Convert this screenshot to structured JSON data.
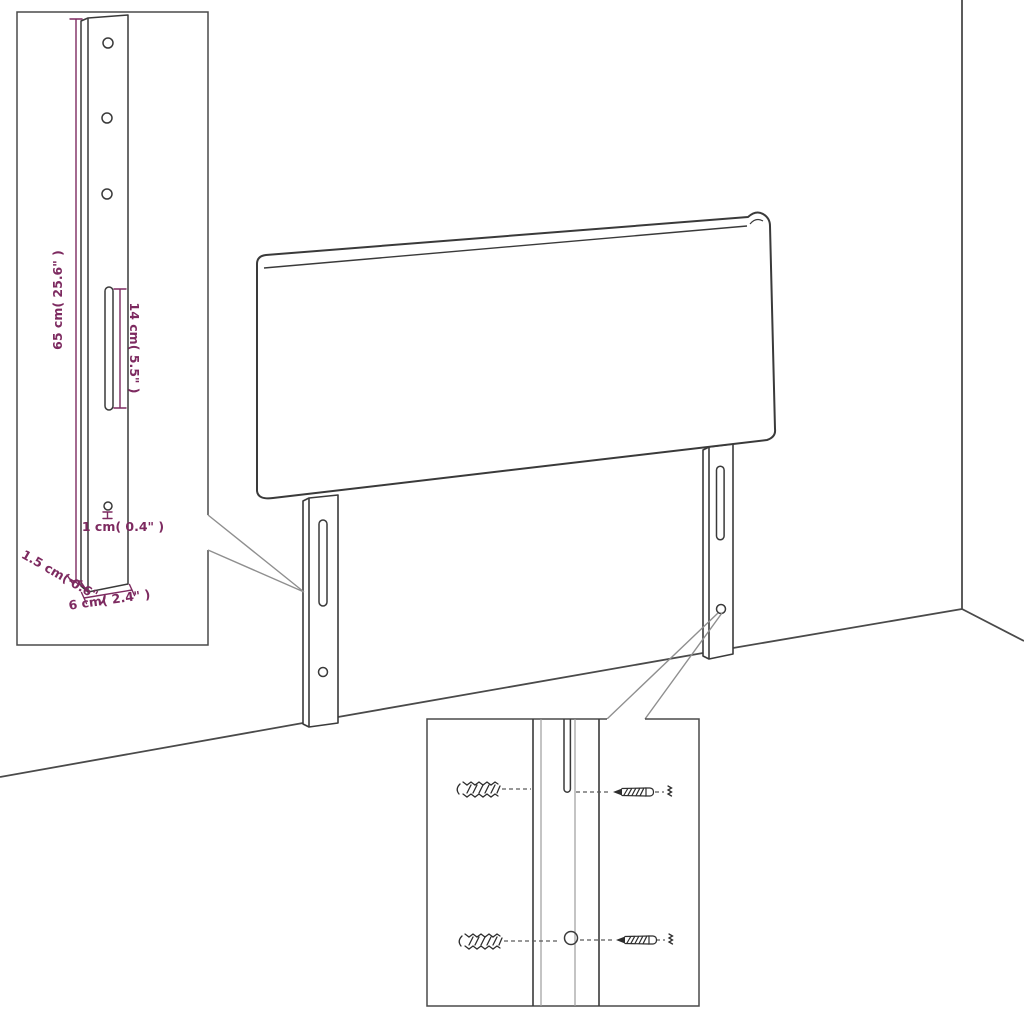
{
  "page": {
    "title": "headboard-assembly-diagram"
  },
  "insets": {
    "bracket_detail": {
      "dims": {
        "height": "65 cm( 25.6\" )",
        "slot_length": "14 cm( 5.5\" )",
        "hole_diameter": "1 cm( 0.4\" )",
        "thickness": "1.5 cm( 0.6\" )",
        "width": "6 cm( 2.4\" )"
      },
      "icons": [
        "mounting-bracket-icon",
        "screw-hole-icon",
        "keyhole-slot-icon"
      ]
    },
    "hardware_detail": {
      "icons": [
        "wall-anchor-icon",
        "screw-icon",
        "mounting-slot-icon",
        "mounting-hole-icon"
      ]
    }
  },
  "colors": {
    "outline": "#3a3a3a",
    "wall": "#4a4a4a",
    "callout": "#8f8f8f",
    "light_line": "#9d9d9d",
    "dashed": "#5a5a5a",
    "hardware": "#2e2e2e",
    "dimension": "#7d2a60",
    "background": "#ffffff"
  }
}
